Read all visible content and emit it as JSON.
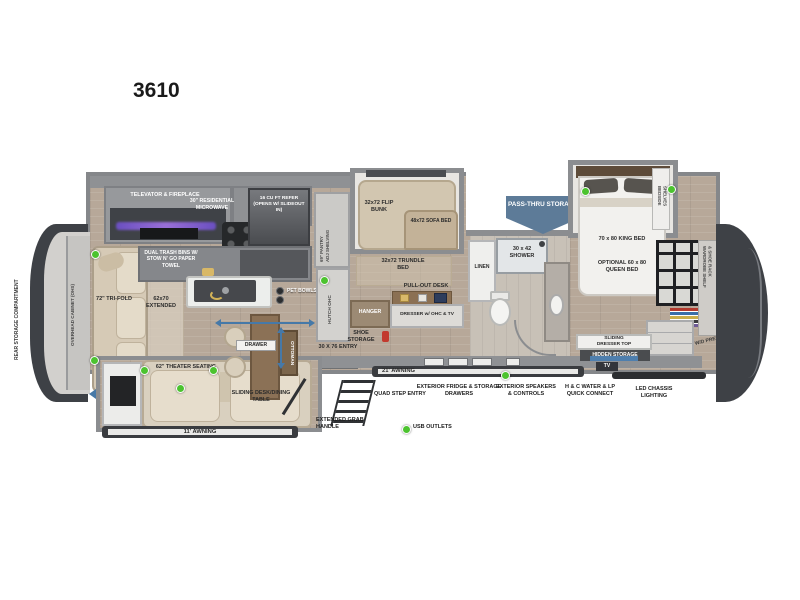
{
  "title": "3610",
  "rear": {
    "storage": "REAR STORAGE COMPARTMENT",
    "ohc": "OVERHEAD CABINET (OHS)"
  },
  "living": {
    "televator": "TELEVATOR & FIREPLACE",
    "sofa": "72\" TRI-FOLD",
    "sofa_ext": "62x70 EXTENDED",
    "theater": "62\" THEATER SEATING",
    "ottoman": "OTTOMAN",
    "drawer": "DRAWER",
    "table": "SLIDING DESK/DINING TABLE"
  },
  "kitchen": {
    "microwave": "30\" RESIDENTIAL MICROWAVE",
    "refer": "16 CU FT REFER (OPENS W/ SLIDEOUT IN)",
    "trash": "DUAL TRASH BINS W/ STOW N' GO PAPER TOWEL",
    "pet": "PET BOWLS",
    "pantry_1": "69\" PANTRY",
    "pantry_2": "ADJ SHELVING",
    "hutch": "HUTCH OHC"
  },
  "bunk": {
    "flip": "32x72 FLIP BUNK",
    "sofa_bed": "48x72 SOFA BED",
    "trundle": "32x72 TRUNDLE BED",
    "desk": "PULL-OUT DESK",
    "dresser": "DRESSER w/ OHC & TV",
    "hanger": "HANGER",
    "shoe": "SHOE STORAGE",
    "entry": "30 X 76 ENTRY"
  },
  "bath": {
    "shower": "30 x 42 SHOWER",
    "linen": "LINEN"
  },
  "bedroom": {
    "king": "70 x 80 KING BED",
    "queen": "OPTIONAL 60 x 80 QUEEN BED",
    "bedside_1": "BEDSIDE",
    "bedside_2": "SHELVES",
    "dresser_top": "SLIDING DRESSER TOP",
    "hidden": "HIDDEN STORAGE",
    "wardrobe_1": "WARDROBE SHELF",
    "wardrobe_2": "& SHOE RACK",
    "wd_prep": "W/D PREP"
  },
  "exterior": {
    "pass_thru": "PASS-THRU STORAGE",
    "awning_rear": "11' AWNING",
    "awning_main": "21' AWNING",
    "quad": "QUAD STEP ENTRY",
    "grab": "EXTENDED GRAB HANDLE",
    "usb": "USB OUTLETS",
    "fridge": "EXTERIOR FRIDGE & STORAGE DRAWERS",
    "speakers": "EXTERIOR SPEAKERS & CONTROLS",
    "water": "H & C WATER & LP QUICK CONNECT",
    "led": "LED CHASSIS LIGHTING",
    "tv": "TV"
  },
  "colors": {
    "usb_dot": "#4cc32f",
    "arrow_blue": "#4679a8",
    "badge_blue": "#5d7b98",
    "cap_dark": "#3e4146"
  }
}
